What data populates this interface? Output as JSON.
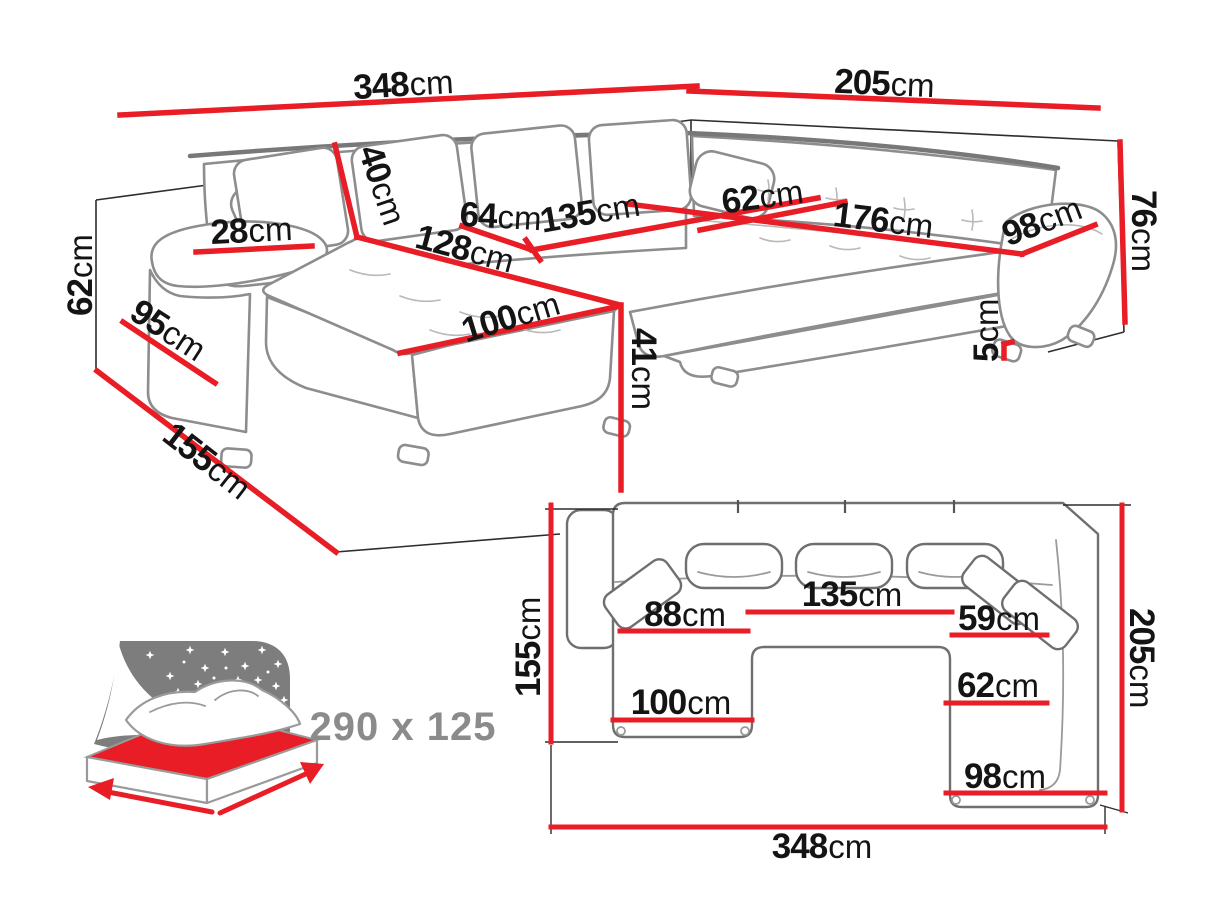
{
  "colors": {
    "dimension_line": "#e81d25",
    "dimension_text": "#141414",
    "sofa_outline": "#8d8d8d",
    "plan_outline": "#6f6f6f",
    "wall_line": "#2d2d2d",
    "icon_gray": "#7d7d7d",
    "bed_label_gray": "#8b8b8b",
    "background": "#ffffff"
  },
  "perspective_view": {
    "dimensions": {
      "total_width": {
        "num": "348",
        "unit": "cm"
      },
      "right_width": {
        "num": "205",
        "unit": "cm"
      },
      "backrest_height": {
        "num": "62",
        "unit": "cm"
      },
      "back_cushion_height": {
        "num": "40",
        "unit": "cm"
      },
      "armrest_width": {
        "num": "28",
        "unit": "cm"
      },
      "armrest_side_depth": {
        "num": "95",
        "unit": "cm"
      },
      "front_depth": {
        "num": "155",
        "unit": "cm"
      },
      "seat_depth_left": {
        "num": "64",
        "unit": "cm"
      },
      "middle_seat_width": {
        "num": "135",
        "unit": "cm"
      },
      "chaise_length": {
        "num": "128",
        "unit": "cm"
      },
      "chaise_width": {
        "num": "100",
        "unit": "cm"
      },
      "seat_height": {
        "num": "41",
        "unit": "cm"
      },
      "seat_depth_right": {
        "num": "62",
        "unit": "cm"
      },
      "right_seat_length": {
        "num": "176",
        "unit": "cm"
      },
      "corner_seat_width": {
        "num": "98",
        "unit": "cm"
      },
      "total_height": {
        "num": "76",
        "unit": "cm"
      },
      "leg_height": {
        "num": "5",
        "unit": "cm"
      }
    }
  },
  "plan_view": {
    "dimensions": {
      "left_depth": {
        "num": "155",
        "unit": "cm"
      },
      "chaise_inner_width": {
        "num": "88",
        "unit": "cm"
      },
      "middle_width": {
        "num": "135",
        "unit": "cm"
      },
      "right_seat_width": {
        "num": "59",
        "unit": "cm"
      },
      "right_seat_depth": {
        "num": "62",
        "unit": "cm"
      },
      "chaise_width": {
        "num": "100",
        "unit": "cm"
      },
      "corner_width": {
        "num": "98",
        "unit": "cm"
      },
      "right_depth": {
        "num": "205",
        "unit": "cm"
      },
      "total_width": {
        "num": "348",
        "unit": "cm"
      }
    }
  },
  "sleeping_function": {
    "bed_size_label": "290 x 125"
  }
}
